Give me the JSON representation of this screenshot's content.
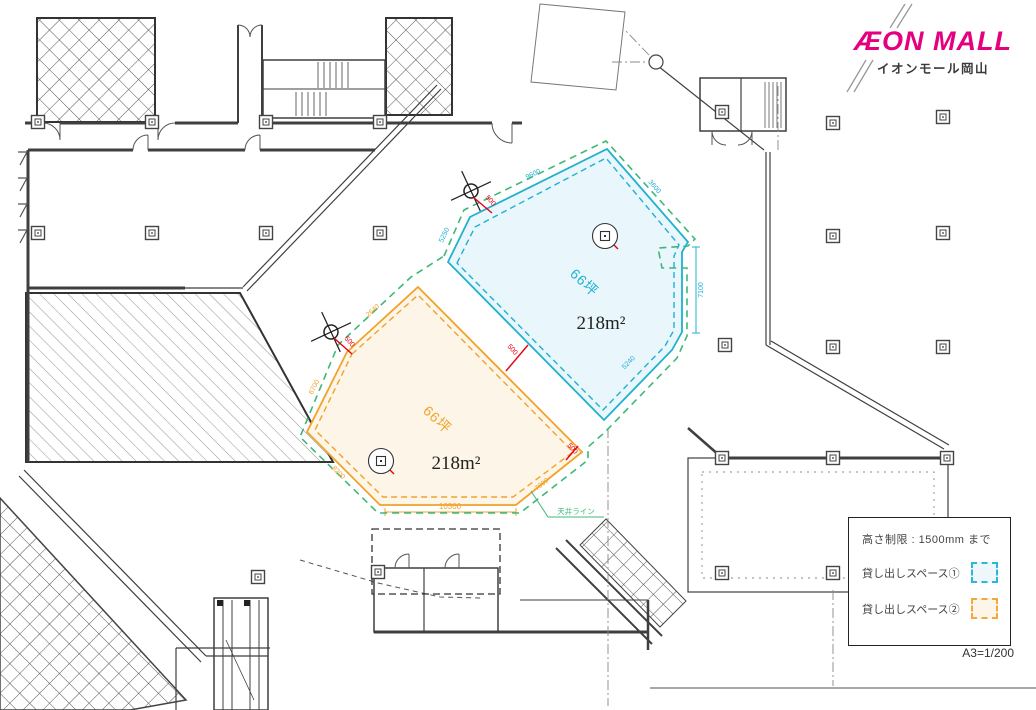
{
  "header": {
    "brand": "ÆON MALL",
    "brand_subtitle": "イオンモール岡山"
  },
  "scale_label": "A3=1/200",
  "legend": {
    "height_limit_label": "高さ制限 : 1500mm まで",
    "items": [
      {
        "label": "貸し出しスペース①",
        "color": "#29b8d8",
        "fill": "#eef8fc"
      },
      {
        "label": "貸し出しスペース②",
        "color": "#f2a83c",
        "fill": "#fdf6e8"
      }
    ]
  },
  "spaces": [
    {
      "name": "貸し出しスペース①",
      "tsubo": "66坪",
      "area": "218m²",
      "dims": {
        "top_left": "9600",
        "left": "5250",
        "top_right": "3600",
        "right": "7100",
        "bottom_right": "5240"
      }
    },
    {
      "name": "貸し出しスペース②",
      "tsubo": "66坪",
      "area": "218m²",
      "dims": {
        "top_left": "2640",
        "left": "6700",
        "bottom_left": "8200",
        "bottom": "10300",
        "bottom_right": "7000"
      }
    }
  ],
  "annotations": {
    "gap": "500",
    "ceiling_line": "天井ライン"
  },
  "colors": {
    "space1": "#1fb1cf",
    "space2": "#f0a32a",
    "dimension_red": "#e60012",
    "ceiling_green": "#3cb878",
    "brand_magenta": "#e4007f"
  }
}
